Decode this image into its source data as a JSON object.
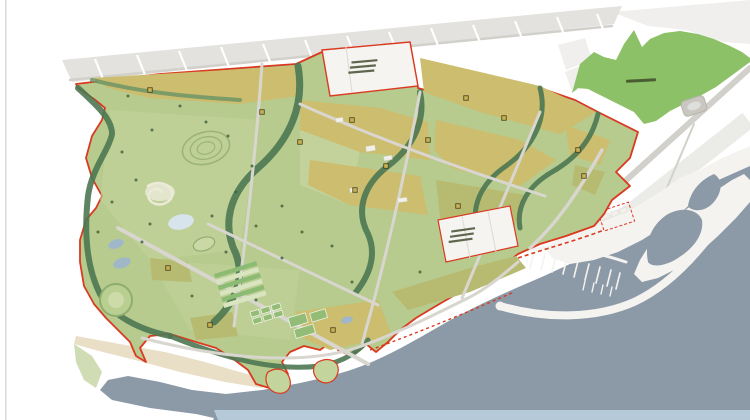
{
  "map": {
    "kind": "coastal-park-master-plan",
    "colors": {
      "page_bg": "#ffffff",
      "edge_line": "#d9d9d9",
      "urban_block": "#e3e2de",
      "urban_road": "#d2d0ca",
      "road": "#d8d6cf",
      "site_park": "#b6cb8d",
      "park_light": "#c3d49c",
      "meadow": "#c9d3a0",
      "parcel_tan": "#cdbd6e",
      "parcel_olive": "#b7bb72",
      "corridor_dark": "#4c7752",
      "corridor_mid": "#6d9566",
      "forest": "#8dc167",
      "sea": "#8c99a7",
      "sea_light": "#b9cede",
      "lake": "#d8e4ec",
      "pond": "#9fb7c9",
      "beach": "#e9dfc7",
      "peninsula_green": "#cfdcb4",
      "white_parcel": "#f5f4f0",
      "boundary_red": "#d93a20",
      "pier_white": "#f4f3ef",
      "marker_fill": "#c9b254",
      "marker_stroke": "#453e1b",
      "label_dark": "#3a4526",
      "stripe_green": "#8cbb74",
      "stripe_pale": "#d9e5bf",
      "court_green": "#93bd77",
      "court_edge": "#eef2e3",
      "building": "#f1f0ea",
      "divider": "#dcdad3",
      "stadium": "#c9c7c0",
      "stadium_ring": "#b5b3ac",
      "stadium_inner": "#dededa",
      "lawn_fill": "#b9cf92",
      "lawn_ring": "#8fae6e",
      "lawn_inner": "#ccdba8",
      "track_fill": "#c9d8a4",
      "swirl": "#ecead9",
      "hill_line": "#9db479",
      "tree": "#44663f"
    },
    "annotations": {
      "forest_area_label": {
        "text_legible": false,
        "lines": 1
      },
      "north_white_parcel_label": {
        "text_legible": false,
        "lines": 3
      },
      "coastal_white_parcel_label": {
        "text_legible": false,
        "lines": 3
      },
      "parcel_marker_count": 15,
      "marina_pier_count": 13
    }
  }
}
